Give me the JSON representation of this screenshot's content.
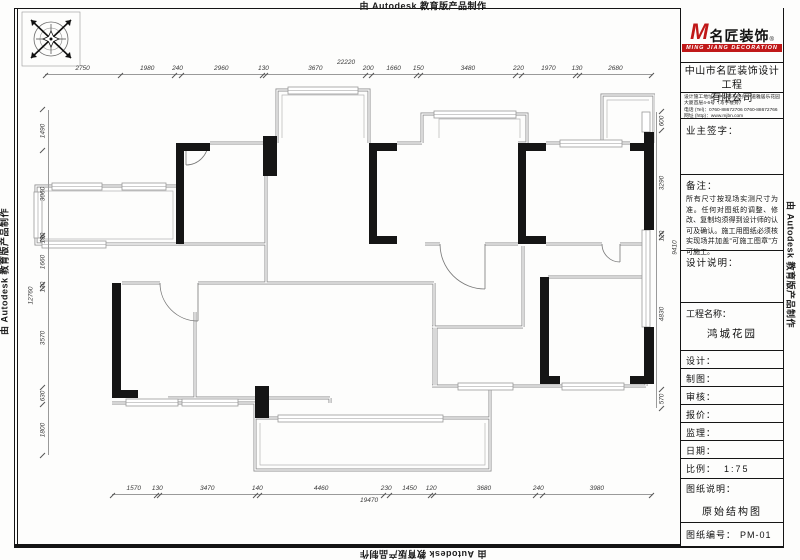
{
  "watermark": {
    "text": "由 Autodesk 教育版产品制作"
  },
  "icons": {
    "compass": "compass-rose-icon"
  },
  "dimensions": {
    "top": {
      "total": "22220",
      "segments": [
        "2750",
        "1980",
        "240",
        "2960",
        "130",
        "3670",
        "200",
        "1660",
        "150",
        "3480",
        "220",
        "1970",
        "130",
        "2680"
      ]
    },
    "bottom": {
      "total": "19470",
      "segments": [
        "1570",
        "130",
        "3470",
        "140",
        "4460",
        "230",
        "1450",
        "120",
        "3680",
        "240",
        "3980"
      ]
    },
    "left": {
      "total": "12760",
      "segments": [
        "1490",
        "3060",
        "130",
        "1660",
        "130",
        "3570",
        "630",
        "1800"
      ]
    },
    "right": {
      "total": "9410",
      "segments": [
        "600",
        "3290",
        "120",
        "4830",
        "570"
      ]
    }
  },
  "titleblock": {
    "logo": {
      "m": "M",
      "brand": "名匠装饰",
      "reg": "®",
      "sub": "MING JIANG DECORATION",
      "accent_color": "#c01818"
    },
    "company_line1": "中山市名匠装饰设计工程",
    "company_line2": "有限公司",
    "address_line1": "设计施工地址：中山市东区兴中道雅居乐花园",
    "address_line2": "大厦首层4-6号（写字楼旁）",
    "tel_line": "电话 (Tel)：0760-88672706  0760-88672766",
    "web_line": "网址 (http)：www.mjbn.com",
    "owner_sign_label": "业主签字：",
    "remark_label": "备注：",
    "remark_text": "所有尺寸按现场实测尺寸为准。任何对图纸的调整、修改、复制均须得到设计师的认可及确认。施工用图纸必须核实现场并加盖“可施工图章”方可施工。",
    "design_note_label": "设计说明：",
    "project_label": "工程名称：",
    "project_name": "鸿城花园",
    "rows": [
      {
        "label": "设计："
      },
      {
        "label": "制图："
      },
      {
        "label": "审核："
      },
      {
        "label": "报价："
      },
      {
        "label": "监理："
      },
      {
        "label": "日期："
      }
    ],
    "scale_label": "比例：",
    "scale_value": "1:75",
    "sheet_note_label": "图纸说明：",
    "sheet_note_value": "原始结构图",
    "sheet_no_label": "图纸编号：",
    "sheet_no_value": "PM-01"
  }
}
